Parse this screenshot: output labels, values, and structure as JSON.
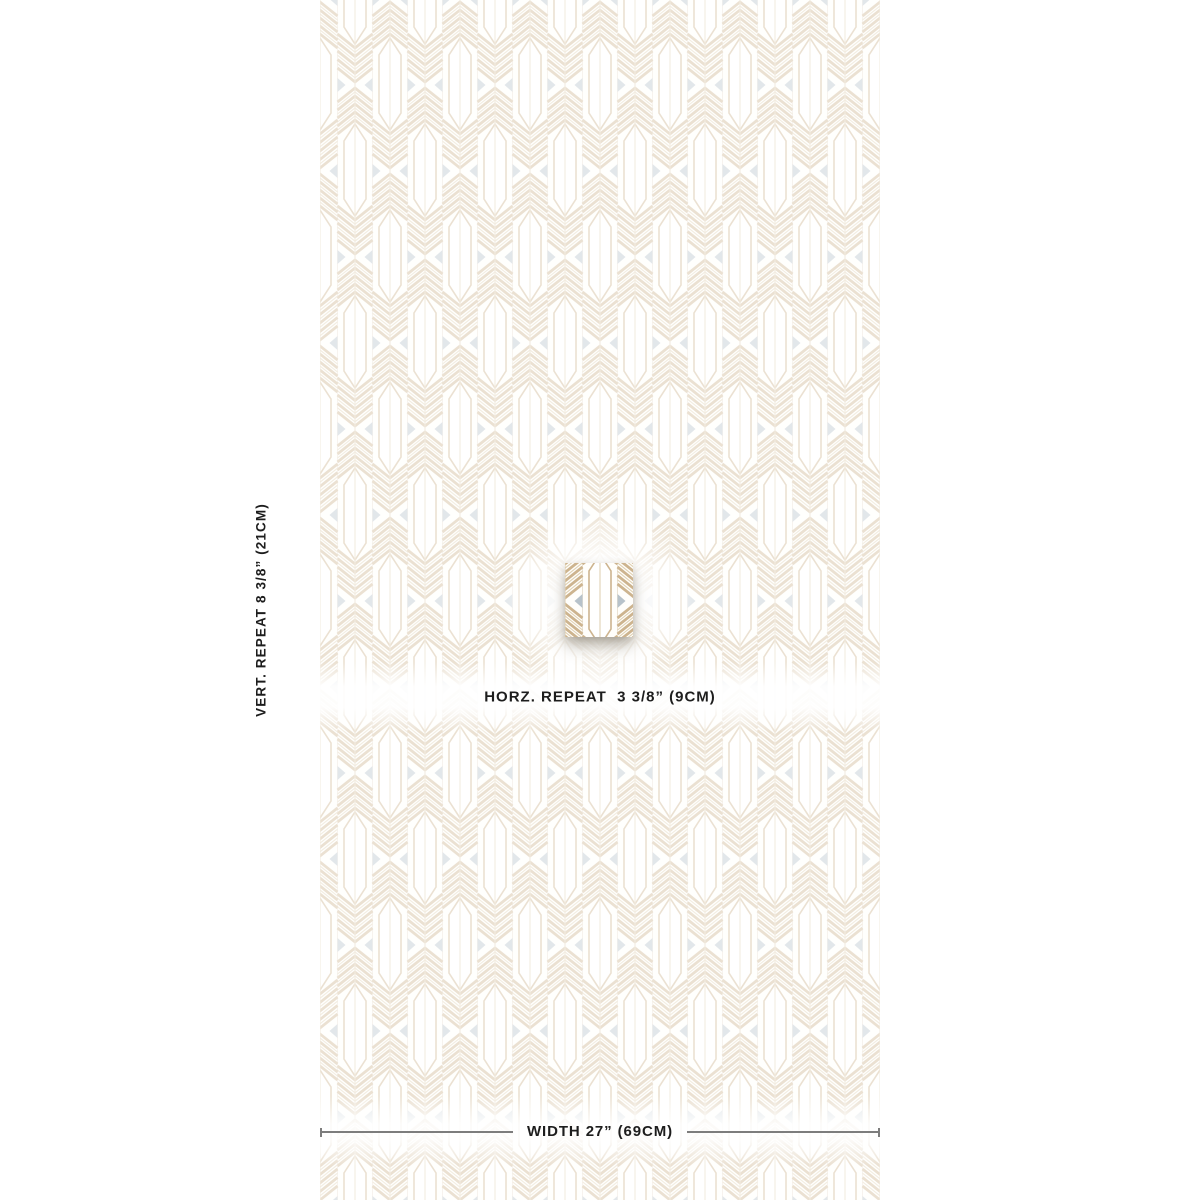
{
  "page": {
    "background": "#ffffff"
  },
  "pattern": {
    "description": "Art deco arrow and chevron feather wallpaper pattern, tan on white, shown faded with one full-color repeat swatch raised at center",
    "columns_shown": 8,
    "horizontal_repeat_px": 70,
    "vertical_repeat_px": 172
  },
  "colors": {
    "page_bg": "#ffffff",
    "pattern_bg": "#fffefb",
    "tan": "#cdb48f",
    "tan_light": "#dfd0b2",
    "boundary_line": "#eae2d4",
    "gray_triangle": "#b7c2ca",
    "text": "#1d1d1d",
    "measure_line": "#7d7d7d"
  },
  "annotations": {
    "vertical_repeat": {
      "label": "VERT. REPEAT 8 3/8” (21CM)",
      "inches": "8 3/8”",
      "cm": "21CM"
    },
    "horizontal_repeat": {
      "label": "HORZ. REPEAT  3 3/8” (9CM)",
      "inches": "3 3/8”",
      "cm": "9CM"
    },
    "width": {
      "label": "WIDTH 27” (69CM)",
      "inches": "27”",
      "cm": "69CM"
    }
  }
}
